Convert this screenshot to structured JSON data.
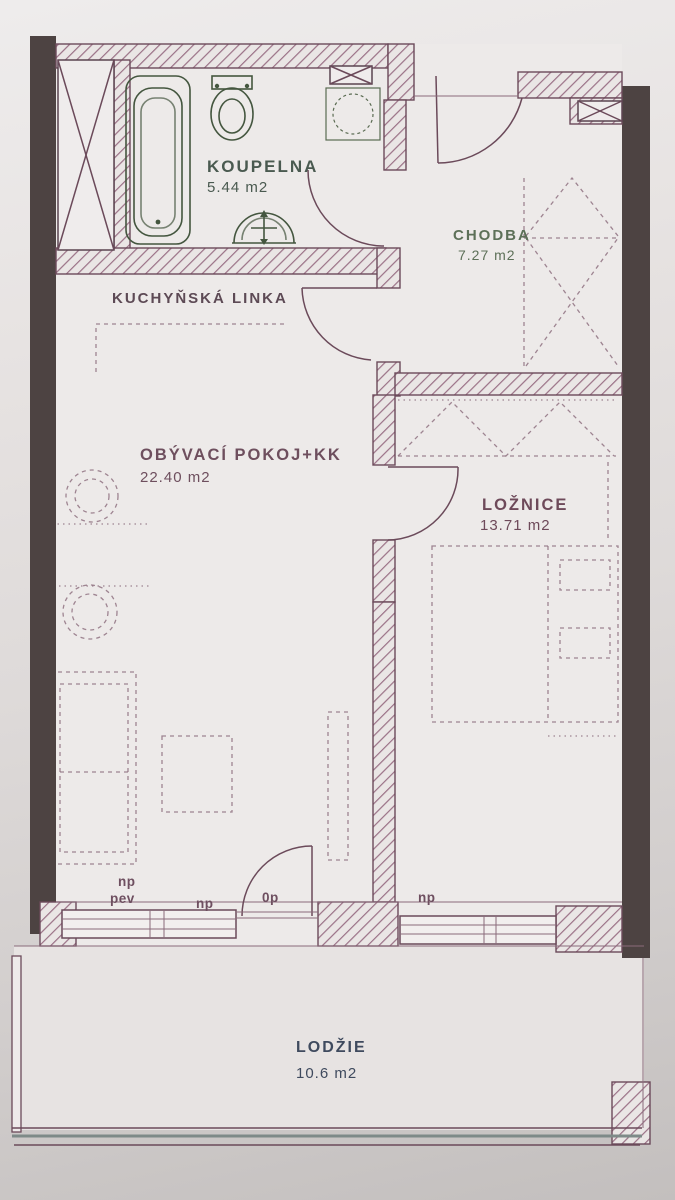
{
  "plan": {
    "rooms": {
      "koupelna": {
        "name": "KOUPELNA",
        "area": "5.44 m2"
      },
      "chodba": {
        "name": "CHODBA",
        "area": "7.27 m2"
      },
      "obyvaci_pokoj": {
        "name": "OBÝVACÍ POKOJ+KK",
        "area": "22.40 m2"
      },
      "loznice": {
        "name": "LOŽNICE",
        "area": "13.71 m2"
      },
      "lodzie": {
        "name": "LODŽIE",
        "area": "10.6 m2"
      }
    },
    "annotations": {
      "kitchen_unit": "KUCHYŇSKÁ LINKA",
      "living_window_label_line1": "np",
      "living_window_label_line2": "pev",
      "living_window_mid_label": "np",
      "balcony_door_label": "0p",
      "bedroom_window_label": "np"
    },
    "colors": {
      "wall_line": "#6b4a5a",
      "hatch": "#9a7186",
      "structural_wall": "#4d4342",
      "fixture_green": "#44563f",
      "furniture_dash": "#8a6a7a",
      "paper": "#e3dfde",
      "label_green": "#4a5a50",
      "label_maroon": "#6e4f5e",
      "label_navy": "#3f4a5e"
    }
  }
}
